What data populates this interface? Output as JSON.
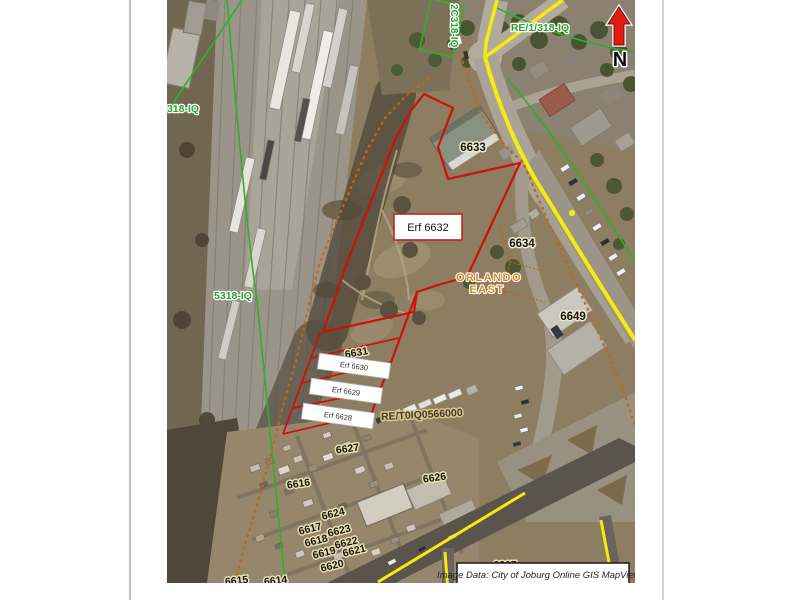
{
  "parcels": {
    "p6633": "6633",
    "p6634": "6634",
    "p6649": "6649",
    "p6631": "6631",
    "p6627": "6627",
    "p6626": "6626",
    "p6616": "6616",
    "p6617": "6617",
    "p6618": "6618",
    "p6619": "6619",
    "p6620": "6620",
    "p6621": "6621",
    "p6622": "6622",
    "p6623": "6623",
    "p6624": "6624",
    "p6614": "6614",
    "p6615": "6615",
    "p6607": "6607"
  },
  "callouts": {
    "erf6632": "Erf 6632",
    "erf6630": "Erf 6630",
    "erf6629": "Erf 6629",
    "erf6628": "Erf 6628"
  },
  "farm_labels": {
    "f318": "318-IQ",
    "f5318": "5318-IQ",
    "fre": "RE/1/318-IQ",
    "frot": "2C318-IQ"
  },
  "area_label": {
    "line1": "ORLANDO",
    "line2": "EAST"
  },
  "re_code": "RE/T0IQ0566000",
  "north": {
    "label": "N"
  },
  "caption": {
    "text": "Image Data: City of Joburg Online GIS MapViewer"
  },
  "colors": {
    "boundary_red": "#ce100e",
    "road_yellow": "#f4ec0c",
    "cadastral_green": "#2fae2f",
    "farm_boundary_orange": "#c06818",
    "label_halo_khaki": "#e8dfb0",
    "area_label_orange": "#e0891a",
    "north_arrow_red": "#e01c10"
  }
}
